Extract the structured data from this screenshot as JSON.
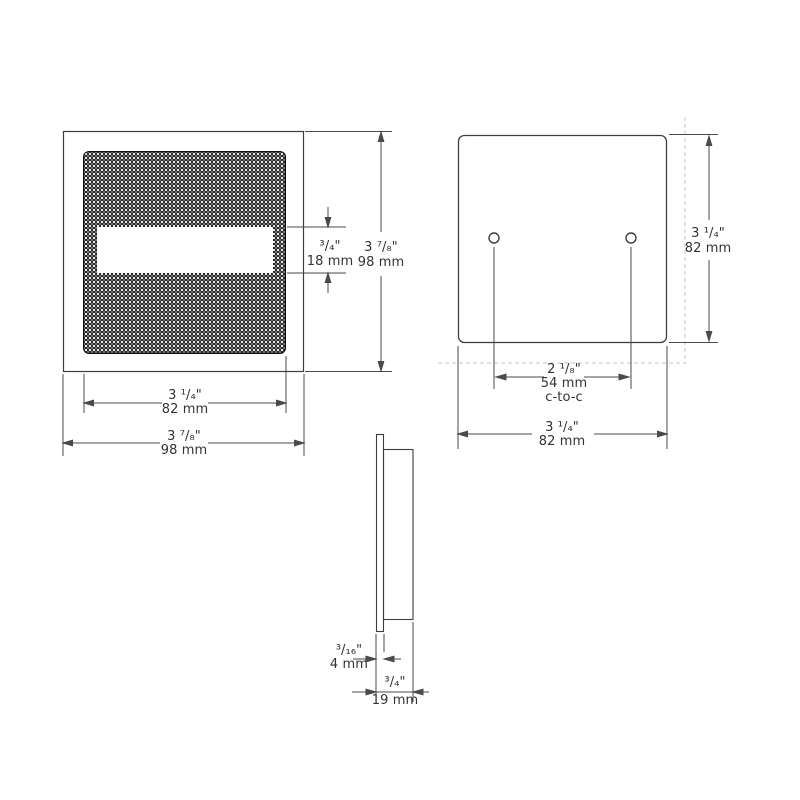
{
  "front_view": {
    "dims": {
      "slot_height": {
        "imperial": "³/₄\"",
        "metric": "18 mm"
      },
      "overall_height": {
        "imperial": "3 ⁷/₈\"",
        "metric": "98 mm"
      },
      "lens_width": {
        "imperial": "3 ¹/₄\"",
        "metric": "82 mm"
      },
      "overall_width": {
        "imperial": "3 ⁷/₈\"",
        "metric": "98 mm"
      }
    }
  },
  "back_view": {
    "dims": {
      "height": {
        "imperial": "3 ¹/₄\"",
        "metric": "82 mm"
      },
      "hole_spacing": {
        "imperial": "2 ¹/₈\"",
        "metric": "54 mm",
        "note": "c-to-c"
      },
      "width": {
        "imperial": "3 ¹/₄\"",
        "metric": "82 mm"
      }
    }
  },
  "side_view": {
    "dims": {
      "faceplate_thickness": {
        "imperial": "³/₁₆\"",
        "metric": "4 mm"
      },
      "overall_depth": {
        "imperial": "³/₄\"",
        "metric": "19 mm"
      }
    }
  },
  "colors": {
    "object_line": "#3d3d3d",
    "dimension_line": "#4a4a4a",
    "dashed_reference": "#cfcfcf",
    "text": "#333333",
    "grille_fill": "#070707",
    "background": "#ffffff"
  }
}
